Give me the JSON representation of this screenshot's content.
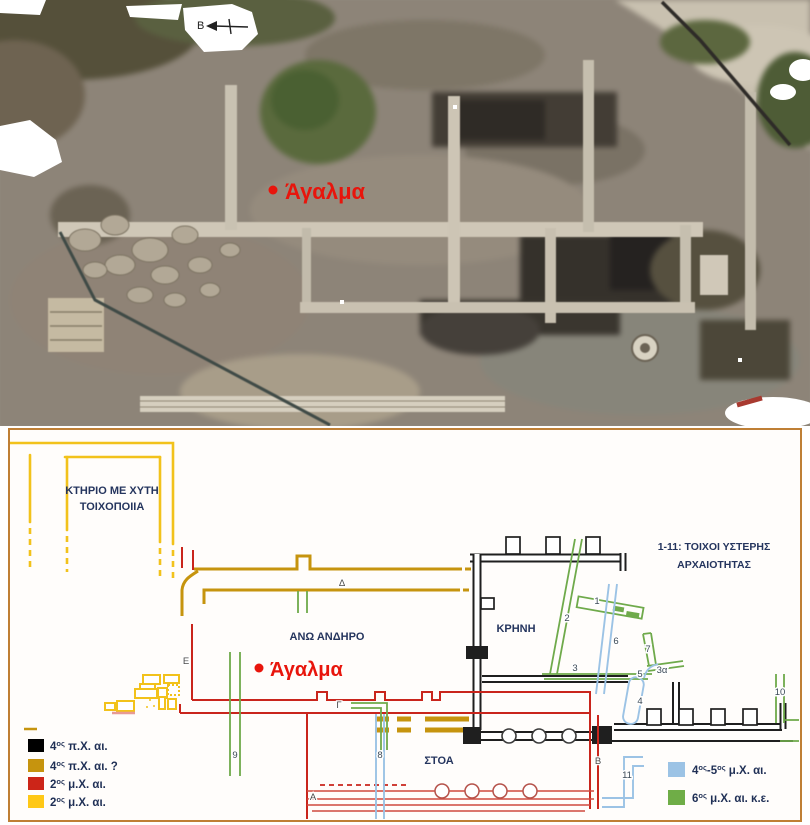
{
  "photo": {
    "north_label": "Β",
    "statue_label": "Άγαλμα",
    "label_color": "#e8150c"
  },
  "plan": {
    "border_color": "#bf7f35",
    "building_line1": "ΚΤΗΡΙΟ ΜΕ ΧΥΤΗ",
    "building_line2": "ΤΟΙΧΟΠΟΙΙΑ",
    "note_line1": "1-11: ΤΟΙΧΟΙ  ΥΣΤΕΡΗΣ",
    "note_line2": "ΑΡΧΑΙΟΤΗΤΑΣ",
    "upper_terrace": "ΑΝΩ ΑΝΔΗΡΟ",
    "fountain": "ΚΡΗΝΗ",
    "stoa": "ΣΤΟΑ",
    "statue_label": "Άγαλμα",
    "letters": {
      "alpha": "Α",
      "beta": "Β",
      "gamma": "Γ",
      "delta": "Δ",
      "epsilon": "Ε"
    },
    "wall_numbers": {
      "n1": "1",
      "n2": "2",
      "n3": "3",
      "n3a": "3α",
      "n4": "4",
      "n5": "5",
      "n6": "6",
      "n7": "7",
      "n8": "8",
      "n9": "9",
      "n10": "10",
      "n11": "11"
    },
    "legend_left": [
      {
        "color": "#000000",
        "parts": [
          {
            "t": "4"
          },
          {
            "t": "ος",
            "sup": true
          },
          {
            "t": " π.Χ. αι."
          }
        ]
      },
      {
        "color": "#c6940e",
        "parts": [
          {
            "t": "4"
          },
          {
            "t": "ος",
            "sup": true
          },
          {
            "t": " π.Χ. αι. ?"
          }
        ]
      },
      {
        "color": "#cc2518",
        "parts": [
          {
            "t": "2"
          },
          {
            "t": "ος",
            "sup": true
          },
          {
            "t": " μ.Χ. αι."
          }
        ]
      },
      {
        "color": "#ffc816",
        "parts": [
          {
            "t": "2"
          },
          {
            "t": "ος",
            "sup": true
          },
          {
            "t": " μ.Χ. αι."
          }
        ]
      }
    ],
    "legend_right": [
      {
        "color": "#9cc3e5",
        "parts": [
          {
            "t": "4"
          },
          {
            "t": "ος",
            "sup": true
          },
          {
            "t": "-5"
          },
          {
            "t": "ος",
            "sup": true
          },
          {
            "t": " μ.Χ. αι."
          }
        ]
      },
      {
        "color": "#6fad47",
        "parts": [
          {
            "t": "6"
          },
          {
            "t": "ος",
            "sup": true
          },
          {
            "t": " μ.Χ. αι. κ.ε."
          }
        ]
      }
    ],
    "colors": {
      "black": "#1f1f1f",
      "ochre": "#c6940e",
      "red": "#c9251c",
      "yellow": "#f2c21b",
      "green": "#6faa4b",
      "blue": "#9cc3e5"
    }
  }
}
